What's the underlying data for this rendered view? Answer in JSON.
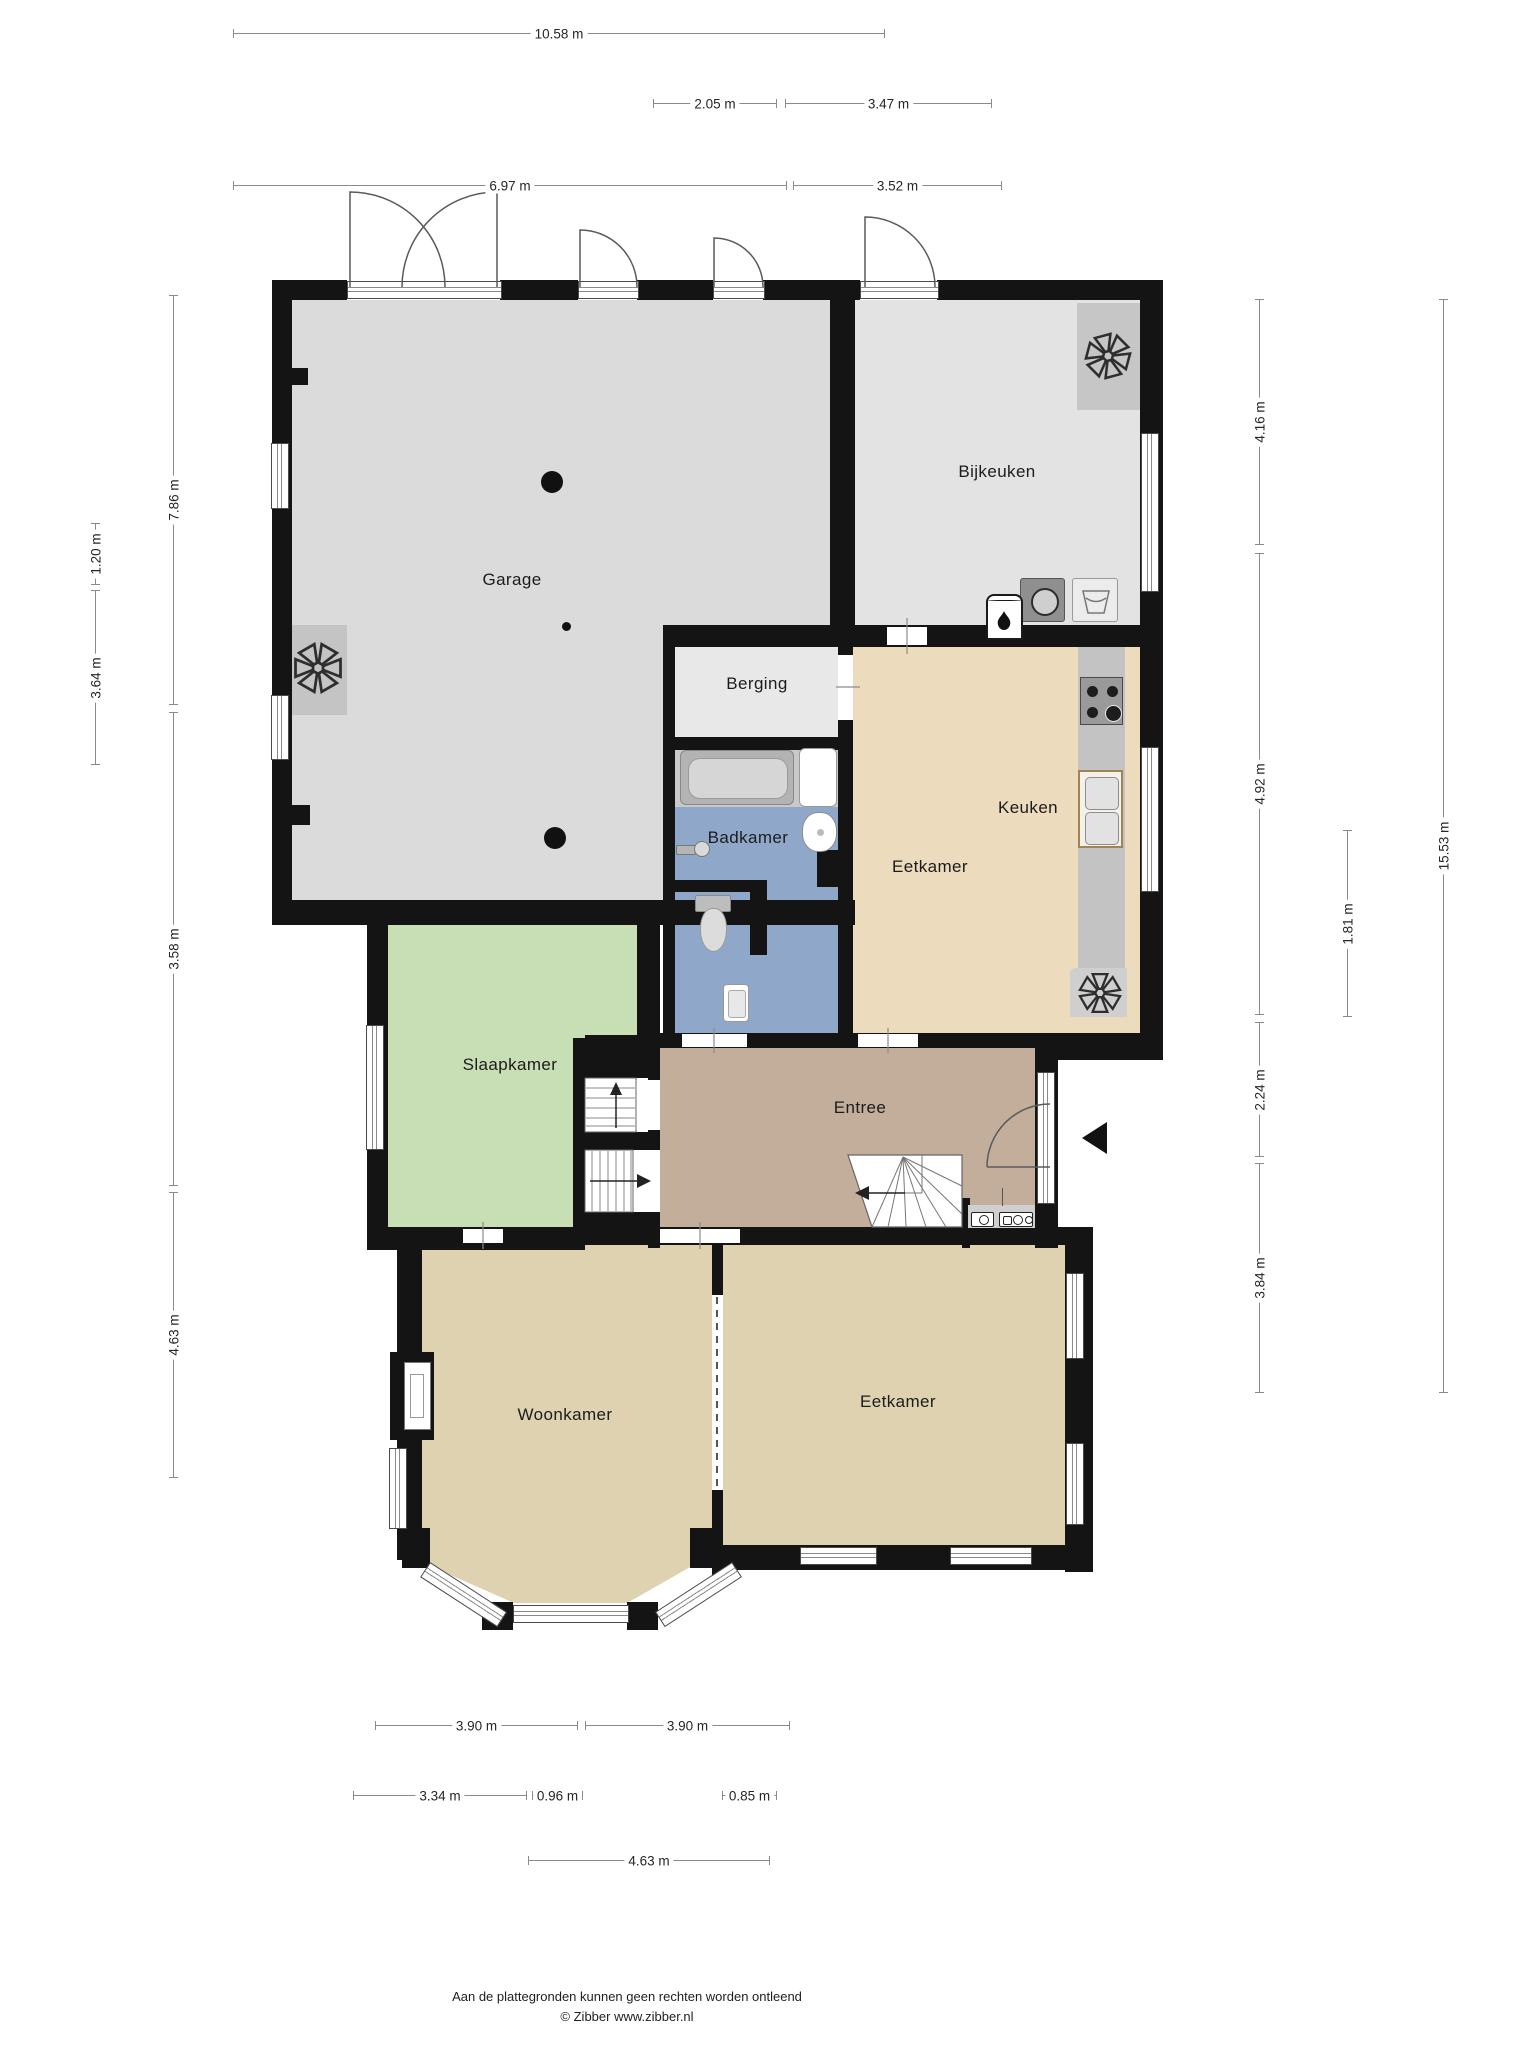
{
  "rooms": {
    "garage": "Garage",
    "bijkeuken": "Bijkeuken",
    "berging": "Berging",
    "badkamer": "Badkamer",
    "keuken": "Keuken",
    "eetkamer_boven": "Eetkamer",
    "slaapkamer": "Slaapkamer",
    "entree": "Entree",
    "woonkamer": "Woonkamer",
    "eetkamer_beneden": "Eetkamer"
  },
  "dims": {
    "top": [
      {
        "label": "10.58 m",
        "value_m": 10.58
      },
      {
        "label": "2.05 m",
        "value_m": 2.05
      },
      {
        "label": "3.47 m",
        "value_m": 3.47
      },
      {
        "label": "6.97 m",
        "value_m": 6.97
      },
      {
        "label": "3.52 m",
        "value_m": 3.52
      }
    ],
    "left": [
      {
        "label": "7.86 m",
        "value_m": 7.86
      },
      {
        "label": "1.20 m",
        "value_m": 1.2
      },
      {
        "label": "3.64 m",
        "value_m": 3.64
      },
      {
        "label": "3.58 m",
        "value_m": 3.58
      },
      {
        "label": "4.63 m",
        "value_m": 4.63
      }
    ],
    "right": [
      {
        "label": "4.16 m",
        "value_m": 4.16
      },
      {
        "label": "4.92 m",
        "value_m": 4.92
      },
      {
        "label": "1.81 m",
        "value_m": 1.81
      },
      {
        "label": "2.24 m",
        "value_m": 2.24
      },
      {
        "label": "3.84 m",
        "value_m": 3.84
      },
      {
        "label": "15.53 m",
        "value_m": 15.53
      }
    ],
    "bottom": [
      {
        "label": "3.90 m",
        "value_m": 3.9
      },
      {
        "label": "3.90 m",
        "value_m": 3.9
      },
      {
        "label": "3.34 m",
        "value_m": 3.34
      },
      {
        "label": "0.96 m",
        "value_m": 0.96
      },
      {
        "label": "0.85 m",
        "value_m": 0.85
      },
      {
        "label": "4.63 m",
        "value_m": 4.63
      }
    ]
  },
  "footer": {
    "disclaimer": "Aan de plattegronden kunnen geen rechten worden ontleend",
    "copyright": "© Zibber www.zibber.nl"
  },
  "colors": {
    "wall": "#141414",
    "garage_floor": "#dbdbdb",
    "bijkeuken_floor": "#e3e3e3",
    "berging_floor": "#e8e8e8",
    "badkamer_floor": "#8fa7c9",
    "slaapkamer_floor": "#c8deb4",
    "entree_floor": "#c2ae9b",
    "keuken_eetkamer_floor": "#ecdbbd",
    "woonkamer_eetkamer_floor": "#ded2b0",
    "counter": "#c6c6c6",
    "dimension_line": "#8a8a8a"
  }
}
